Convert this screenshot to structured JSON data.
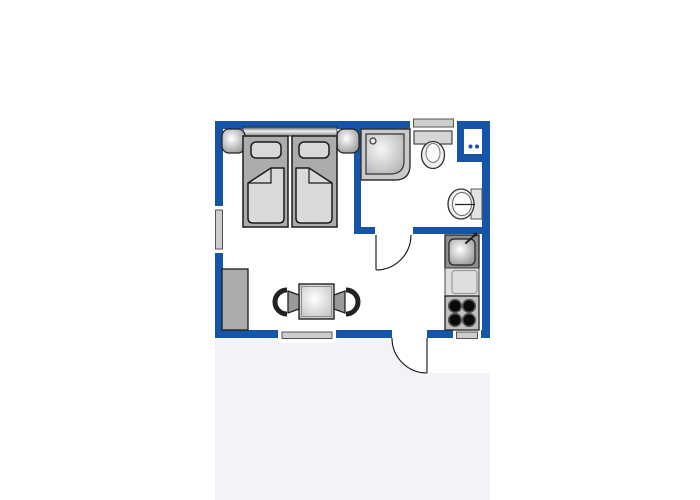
{
  "meta": {
    "description": "Studio apartment floor plan (no text labels in image)",
    "view": "top-down architectural plan"
  },
  "colors": {
    "page": "#ffffff",
    "outside": "#F2F3F7",
    "floor": "#ffffff",
    "wall": "#1554A6",
    "windowbar": "#CDCDCD",
    "mattress": "#ACACAC",
    "bedding": "#D9D9D9",
    "fixture": "#EFEFEF",
    "furniture": "#ABABAB",
    "showerbody": "#CACACA",
    "sinkunit": "#8F8F8F",
    "stovepanel": "#BFBFBF",
    "burner": "#0A0A0A",
    "outline": "#1C1C1C"
  },
  "fixtures": [
    "double-bed",
    "headboard",
    "nightstand-left",
    "nightstand-right",
    "shower",
    "shower-drain",
    "toilet",
    "toilet-cistern",
    "washbasin",
    "ventilation-shaft",
    "kitchen-sink",
    "kitchen-counter",
    "stove",
    "wardrobe",
    "dining-table",
    "chair-left",
    "chair-right"
  ],
  "openings": [
    "window-left-wall",
    "window-top-wall",
    "window-bottom-wall",
    "window-kitchen-bottom",
    "bathroom-door",
    "entrance-door"
  ]
}
